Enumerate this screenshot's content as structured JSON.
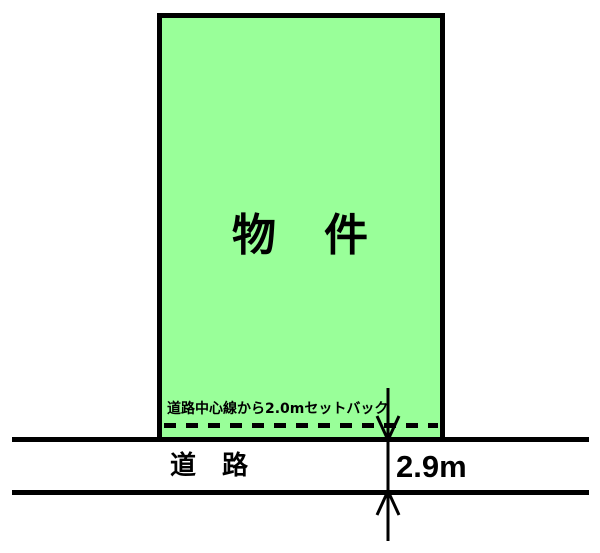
{
  "diagram": {
    "property_label": "物　件",
    "setback_note": "道路中心線から2.0mセットバック",
    "road_label": "道　路",
    "road_width_label": "2.9m",
    "colors": {
      "property_fill": "#99FF99",
      "line_color": "#000000",
      "background": "#FFFFFF"
    }
  }
}
